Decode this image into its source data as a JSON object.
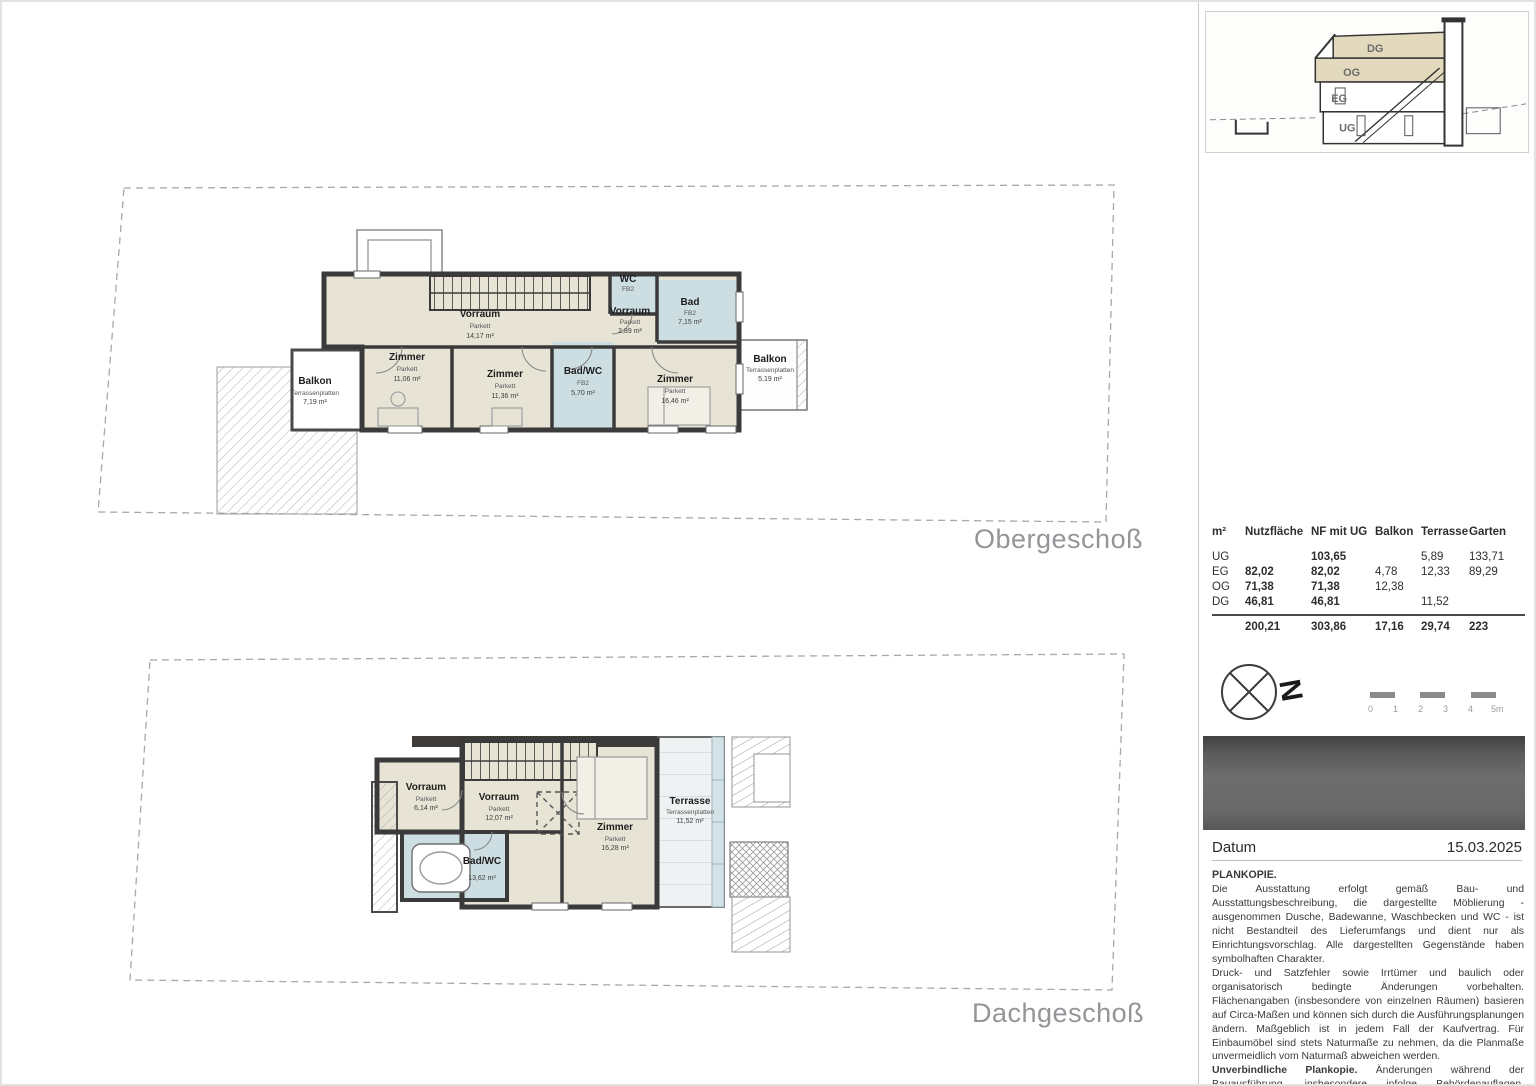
{
  "plans": {
    "og_title": "Obergeschoß",
    "dg_title": "Dachgeschoß"
  },
  "og_plan": {
    "rooms": {
      "vorraum_main": {
        "name": "Vorraum",
        "finish": "Parkett",
        "area": "14,17 m²"
      },
      "zimmer_left": {
        "name": "Zimmer",
        "finish": "Parkett",
        "area": "11,06 m²"
      },
      "zimmer_mid": {
        "name": "Zimmer",
        "finish": "Parkett",
        "area": "11,36 m²"
      },
      "bad_wc": {
        "name": "Bad/WC",
        "finish": "FB2",
        "area": "5,70 m²"
      },
      "zimmer_right": {
        "name": "Zimmer",
        "finish": "Parkett",
        "area": "16,46 m²"
      },
      "vorraum_small": {
        "name": "Vorraum",
        "finish": "Parkett",
        "area": "2,89 m²"
      },
      "wc": {
        "name": "WC",
        "finish": "FB2"
      },
      "bad": {
        "name": "Bad",
        "finish": "FB2",
        "area": "7,15 m²"
      },
      "balkon_left": {
        "name": "Balkon",
        "finish": "Terrassenplatten",
        "area": "7,19 m²"
      },
      "balkon_right": {
        "name": "Balkon",
        "finish": "Terrassenplatten",
        "area": "5,19 m²"
      }
    }
  },
  "dg_plan": {
    "rooms": {
      "vorraum_left": {
        "name": "Vorraum",
        "finish": "Parkett",
        "area": "6,14 m²"
      },
      "vorraum_main": {
        "name": "Vorraum",
        "finish": "Parkett",
        "area": "12,07 m²"
      },
      "zimmer": {
        "name": "Zimmer",
        "finish": "Parkett",
        "area": "16,28 m²"
      },
      "bad_wc": {
        "name": "Bad/WC",
        "finish": "FB2",
        "area": "13,62 m²"
      },
      "terrasse": {
        "name": "Terrasse",
        "finish": "Terrassenplatten",
        "area": "11,52 m²"
      }
    }
  },
  "section": {
    "labels": {
      "dg": "DG",
      "og": "OG",
      "eg": "EG",
      "ug": "UG"
    }
  },
  "area_table": {
    "headers": [
      "m²",
      "Nutzfläche",
      "NF mit UG",
      "Balkon",
      "Terrasse",
      "Garten"
    ],
    "rows": [
      {
        "floor": "UG",
        "nutzflaeche": "",
        "nf_mit_ug": "103,65",
        "balkon": "",
        "terrasse": "5,89",
        "garten": "133,71"
      },
      {
        "floor": "EG",
        "nutzflaeche": "82,02",
        "nf_mit_ug": "82,02",
        "balkon": "4,78",
        "terrasse": "12,33",
        "garten": "89,29"
      },
      {
        "floor": "OG",
        "nutzflaeche": "71,38",
        "nf_mit_ug": "71,38",
        "balkon": "12,38",
        "terrasse": "",
        "garten": ""
      },
      {
        "floor": "DG",
        "nutzflaeche": "46,81",
        "nf_mit_ug": "46,81",
        "balkon": "",
        "terrasse": "11,52",
        "garten": ""
      }
    ],
    "totals": {
      "nutzflaeche": "200,21",
      "nf_mit_ug": "303,86",
      "balkon": "17,16",
      "terrasse": "29,74",
      "garten": "223"
    }
  },
  "compass": {
    "north_label": "N"
  },
  "scalebar": {
    "ticks": [
      "0",
      "1",
      "2",
      "3",
      "4",
      "5m"
    ]
  },
  "footer": {
    "datum_label": "Datum",
    "datum_value": "15.03.2025"
  },
  "legal": {
    "heading": "PLANKOPIE.",
    "p1": "Die Ausstattung erfolgt gemäß Bau- und Ausstattungsbeschreibung, die dargestellte Möblierung - ausgenommen Dusche, Badewanne, Waschbecken und WC - ist nicht Bestandteil des Lieferumfangs und dient nur als Einrichtungsvorschlag. Alle dargestellten Gegenstände haben symbolhaften Charakter.",
    "p2": "Druck- und Satzfehler sowie Irrtümer und baulich oder organisatorisch bedingte Änderungen vorbehalten. Flächenangaben (insbesondere von einzelnen Räumen) basieren auf Circa-Maßen und können sich durch die Ausführungsplanungen ändern. Maßgeblich ist in jedem Fall der Kaufvertrag. Für Einbaumöbel sind stets Naturmaße zu nehmen, da die Planmaße unvermeidlich vom Naturmaß abweichen werden.",
    "p3_bold": "Unverbindliche Plankopie.",
    "p3_rest": " Änderungen während der Bauausführung, insbesondere infolge Behördenauflagen, haustechnischer und konstruktiver Maßnahmen vorbehalten!"
  },
  "colors": {
    "wall": "#3a3a3a",
    "room_fill": "#e7e3d5",
    "bath_fill": "#cddee3",
    "section_highlight": "#e3d9bd",
    "boundary": "#a8a8a8"
  }
}
